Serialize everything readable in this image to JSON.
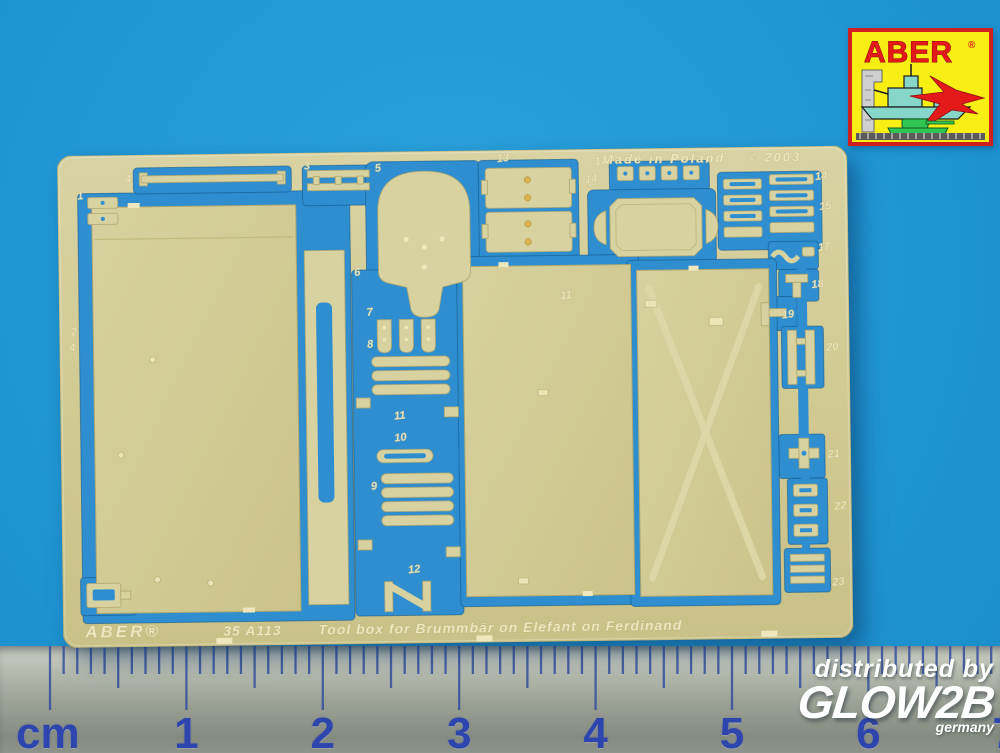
{
  "photo": {
    "background_color": "#2099d6",
    "subject": "ABER photo-etched brass detail sheet on blue background with centimeter ruler"
  },
  "sheet": {
    "brass_color": "#d3cd97",
    "cutout_color": "#2e8ecf",
    "etched_top_left": "Made in Poland",
    "etched_top_right": "© 2003",
    "etched_bottom_brand": "ABER®",
    "etched_bottom_code": "35 A113",
    "etched_bottom_title": "Tool box for Brummbär on Elefant on Ferdinand",
    "part_labels": [
      {
        "n": "4",
        "x": 68,
        "y": 28
      },
      {
        "n": "1",
        "x": 20,
        "y": 44
      },
      {
        "n": "2",
        "x": 12,
        "y": 180
      },
      {
        "n": "4",
        "x": 10,
        "y": 196
      },
      {
        "n": "3",
        "x": 247,
        "y": 17
      },
      {
        "n": "5",
        "x": 318,
        "y": 20
      },
      {
        "n": "13",
        "x": 440,
        "y": 12
      },
      {
        "n": "13",
        "x": 538,
        "y": 16
      },
      {
        "n": "14",
        "x": 528,
        "y": 34
      },
      {
        "n": "14",
        "x": 758,
        "y": 34
      },
      {
        "n": "15",
        "x": 762,
        "y": 64
      },
      {
        "n": "17",
        "x": 760,
        "y": 105
      },
      {
        "n": "18",
        "x": 753,
        "y": 142
      },
      {
        "n": "19",
        "x": 723,
        "y": 172
      },
      {
        "n": "20",
        "x": 767,
        "y": 205
      },
      {
        "n": "21",
        "x": 767,
        "y": 312
      },
      {
        "n": "22",
        "x": 773,
        "y": 364
      },
      {
        "n": "23",
        "x": 770,
        "y": 440
      },
      {
        "n": "6",
        "x": 296,
        "y": 124
      },
      {
        "n": "7",
        "x": 308,
        "y": 164
      },
      {
        "n": "8",
        "x": 308,
        "y": 196
      },
      {
        "n": "11",
        "x": 334,
        "y": 268
      },
      {
        "n": "10",
        "x": 334,
        "y": 290
      },
      {
        "n": "9",
        "x": 310,
        "y": 338
      },
      {
        "n": "12",
        "x": 346,
        "y": 422
      },
      {
        "n": "11",
        "x": 502,
        "y": 150
      }
    ]
  },
  "ruler": {
    "unit_label": "cm",
    "numbers": [
      "1",
      "2",
      "3",
      "4",
      "5",
      "6",
      "7"
    ],
    "tick_color": "#35509f",
    "number_color": "#2e45ad"
  },
  "watermark": {
    "line1": "distributed by",
    "brand": "GLOW2B",
    "country": "germany",
    "color": "#ffffff"
  },
  "logo": {
    "brand": "ABER",
    "registered_mark": "®",
    "colors": {
      "background": "#f7ee14",
      "border": "#d01f1f",
      "text": "#e41a1a",
      "ship": "#86d7c9",
      "jet": "#e41a1a",
      "tank": "#31c553",
      "square_tool": "#cfcfcf"
    }
  }
}
